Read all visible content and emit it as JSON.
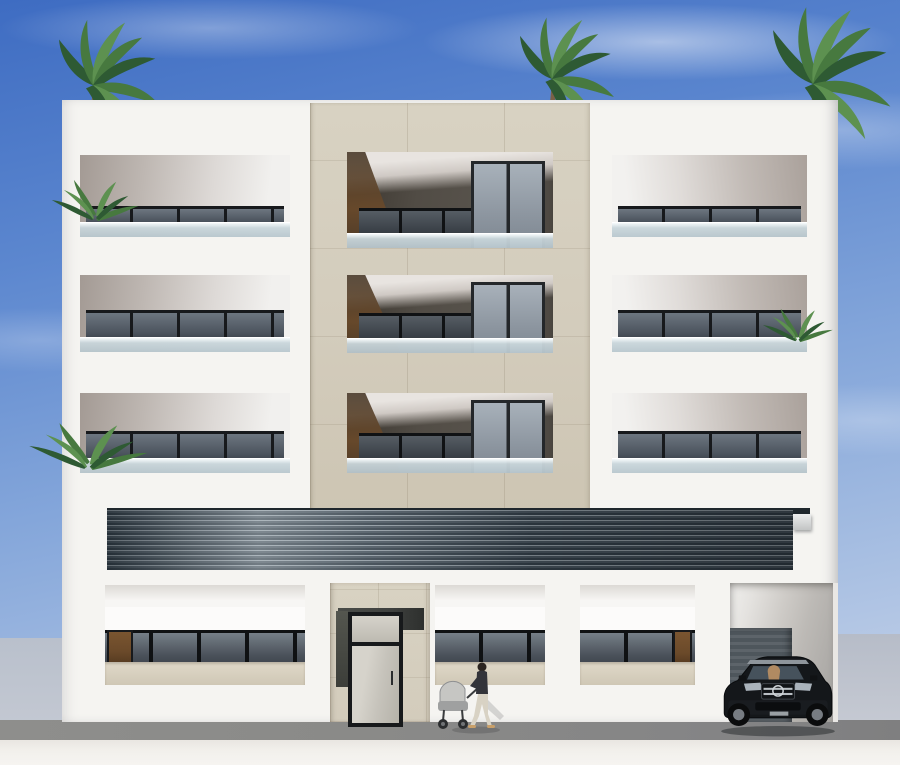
{
  "scene": {
    "type": "architectural-render",
    "subject": "Front elevation of a modern four-storey residential apartment building",
    "setting": "daytime, clear blue sky with light clouds, street level pavement",
    "visible_text": ""
  },
  "building": {
    "storeys": 4,
    "upper_balcony_rows": 3,
    "columns": [
      "white-balcony-wing-left",
      "beige-stone-center",
      "white-balcony-wing-right"
    ],
    "ground_floor_units": [
      "storefront-left",
      "entrance-portal-with-glass-door",
      "storefront-center",
      "storefront-right",
      "garage-opening"
    ],
    "features": [
      "frameless-glass-balustrades",
      "dark-aluminium-glazing",
      "dark-louvre-commercial-band",
      "timber-accent-doors",
      "stone-tile-grid"
    ]
  },
  "objects": {
    "roof_palm_trees": 3,
    "balcony_plants": 3,
    "pedestrian": "woman pushing a pram",
    "pram_count": 1,
    "vehicle": "dark SUV parked in garage opening"
  },
  "colors": {
    "sky-top": "#3e6cc2",
    "sky-mid": "#84a6da",
    "sky-horizon": "#c3d1e8",
    "facade": "#f5f4f1",
    "stone": "#d3ccbc",
    "bronze": "#58534c",
    "timber": "#6b4a2a",
    "glazing-frame": "#17191c",
    "glazing-pane": "#6d7680",
    "railing-glass": "#c9d6db",
    "louvre-dark": "#333f49",
    "louvre-light": "#8d98a0",
    "portal-recess": "#3f413f",
    "garage-wall": "#bdbab6",
    "garage-door": "#4e565c",
    "side-wall": "#b9c0cc",
    "road": "#8a8a88",
    "walkway": "#f2f0ec",
    "car-body": "#14171a",
    "car-chrome": "#b9bfc4",
    "car-glass": "#46525c",
    "foliage-dark": "#2e5a33",
    "foliage": "#47793f",
    "foliage-light": "#5d9150",
    "trunk": "#7a6148",
    "person-top": "#33343a",
    "person-pants": "#d8d2c4",
    "skin": "#d9b38c",
    "pram": "#c6c6c3"
  }
}
